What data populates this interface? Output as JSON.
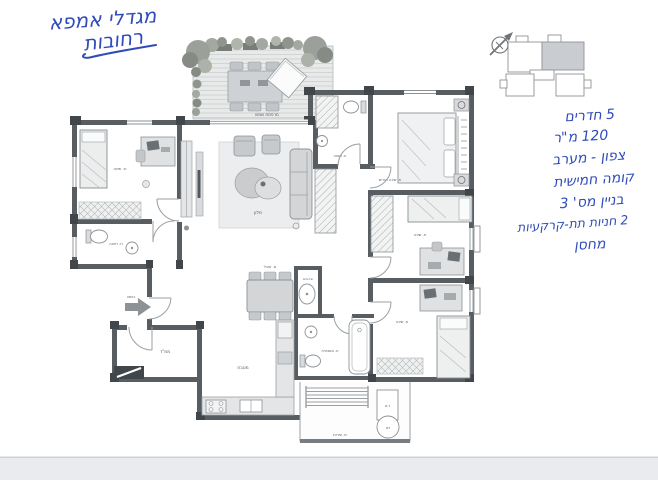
{
  "annotations": {
    "ink_color": "#2f4cb8",
    "title_line1": "מגדלי אמפא",
    "title_line2": "רחובות",
    "notes": [
      "5 חדרים",
      "120 מ\"ר",
      "צפון - מערב",
      "קומה חמישית",
      "בניין מס' 3",
      "2 חניות תת-קרקעיות",
      "מחסן"
    ]
  },
  "key_plan": {
    "unit_fill": "#c9ccd0",
    "outline_color": "#8f9498"
  },
  "floor_plan": {
    "colors": {
      "wall": "#585d61",
      "pier": "#41464a",
      "thin_line": "#9aa0a4",
      "furniture_fill": "#d8dadc",
      "deck_fill": "#e8e9e9",
      "plant": "#9ba19a",
      "label": "#55595d",
      "scan_strip": "#e9ebee"
    },
    "labels": {
      "terrace": "מרפסת שמש",
      "living": "סלון",
      "dining": "פ. אוכל",
      "kitchen": "מטבח",
      "master_bedroom": "ח. שינה הורים",
      "bedroom_left": "ח. שינה",
      "bedroom_mid": "ח. שינה",
      "bedroom_bottom": "ח. שינה",
      "safe_room": "ממ\"ד",
      "bath_left": "ח. רחצה",
      "bath_master": "ח. רחצה",
      "bath_main": "ח. אמבטיה",
      "wc": "שירותים",
      "service_balcony": "מ. שירות",
      "entrance": "כניסה",
      "boiler": "דש",
      "cabinet": "ד.ש"
    }
  }
}
